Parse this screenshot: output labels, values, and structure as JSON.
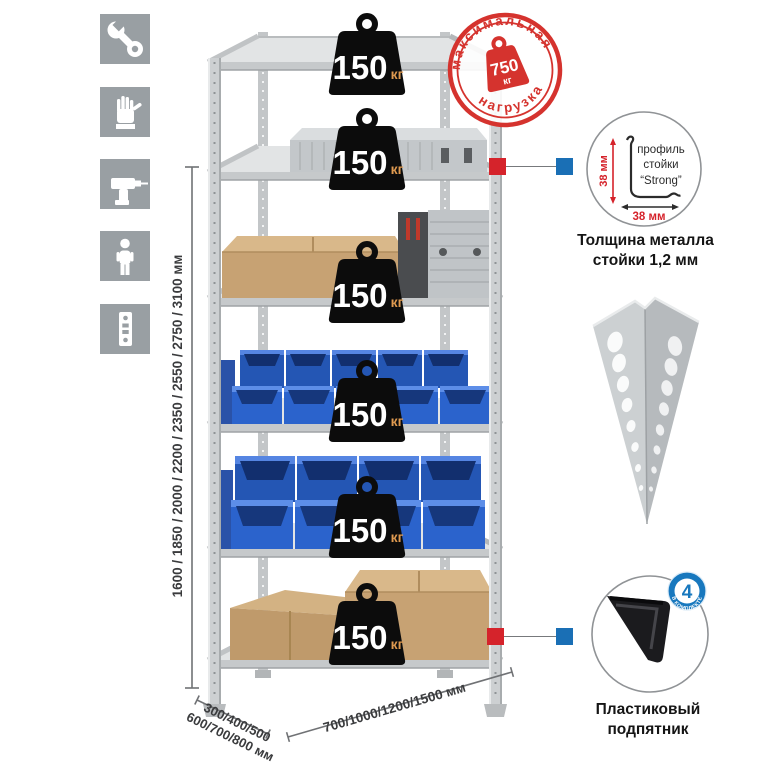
{
  "colors": {
    "accent_red": "#d5232b",
    "accent_blue": "#1a6fb5",
    "badge_blue": "#1878be",
    "bin_blue": "#2b63cc",
    "metal_gray": "#cdd0d2",
    "cardboard_tan": "#c7a273",
    "icon_gray": "#999fa3",
    "weight_black": "#0c0c0c",
    "kg_orange": "#df9a50"
  },
  "icons_panel": {
    "items": [
      "wrench",
      "gloves",
      "drill",
      "person",
      "perforated-strip"
    ]
  },
  "dimensions": {
    "height": "1600 / 1850 / 2000 / 2200 / 2350 / 2550 / 2750 / 3100 мм",
    "depth_line1": "300/400/500",
    "depth_line2": "600/700/800 мм",
    "width": "700/1000/1200/1500 мм"
  },
  "rack": {
    "shelf_loads": [
      {
        "value": "150",
        "unit": "кг"
      },
      {
        "value": "150",
        "unit": "кг"
      },
      {
        "value": "150",
        "unit": "кг"
      },
      {
        "value": "150",
        "unit": "кг"
      },
      {
        "value": "150",
        "unit": "кг"
      },
      {
        "value": "150",
        "unit": "кг"
      }
    ]
  },
  "stamp": {
    "arc_top": "максимальная",
    "arc_bottom": "нагрузка",
    "value": "750",
    "unit": "кг"
  },
  "profile_detail": {
    "label_line1": "профиль",
    "label_line2": "стойки",
    "label_line3": "“Strong”",
    "dim_vertical": "38 мм",
    "dim_horizontal": "38 мм",
    "caption_line1": "Толщина металла",
    "caption_line2": "стойки 1,2 мм"
  },
  "foot_detail": {
    "badge_value": "4",
    "badge_arc": "в комплекте",
    "caption_line1": "Пластиковый",
    "caption_line2": "подпятник"
  }
}
